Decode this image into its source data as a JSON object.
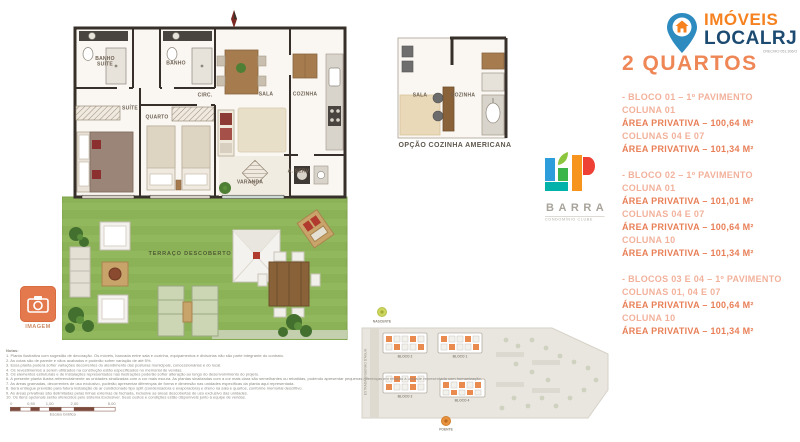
{
  "brand": {
    "top": "IMÓVEIS",
    "bottom": "LOCALRJ",
    "tagline": "CRECI/RJ 051.306/O"
  },
  "details": {
    "title": "2 QUARTOS",
    "sections": [
      {
        "lines": [
          {
            "t": "- BLOCO 01 – 1º PAVIMENTO"
          },
          {
            "t": "COLUNA 01"
          },
          {
            "t": "ÁREA PRIVATIVA – 100,64 M²"
          },
          {
            "t": "COLUNAS 04 E 07"
          },
          {
            "t": "ÁREA PRIVATIVA – 101,34 M²"
          }
        ]
      },
      {
        "lines": [
          {
            "t": "- BLOCO 02 – 1º PAVIMENTO"
          },
          {
            "t": "COLUNA 01"
          },
          {
            "t": "ÁREA PRIVATIVA – 101,01 M²"
          },
          {
            "t": "COLUNAS 04 E 07"
          },
          {
            "t": "ÁREA PRIVATIVA – 100,64 M²"
          },
          {
            "t": "COLUNA 10"
          },
          {
            "t": "ÁREA PRIVATIVA – 101,34 M²"
          }
        ]
      },
      {
        "lines": [
          {
            "t": "- BLOCOS 03 E 04 – 1º PAVIMENTO"
          },
          {
            "t": "COLUNAS 01, 04 E 07"
          },
          {
            "t": "ÁREA PRIVATIVA – 100,64 M²"
          },
          {
            "t": "COLUNA 10"
          },
          {
            "t": "ÁREA PRIVATIVA – 101,34 M²"
          }
        ]
      }
    ]
  },
  "up_logo": {
    "mark": "UP",
    "name": "BARRA",
    "subtitle": "CONDOMÍNIO CLUBE"
  },
  "plan": {
    "rooms": {
      "banho_suite": "BANHO\nSUÍTE",
      "banho": "BANHO",
      "circ": "CIRC.",
      "suite": "SUÍTE",
      "quarto": "QUARTO",
      "sala": "SALA",
      "cozinha": "COZINHA",
      "aserv": "A. SERV.",
      "varanda": "VARANDA",
      "terraco": "TERRAÇO DESCOBERTO"
    }
  },
  "option_plan": {
    "caption": "OPÇÃO COZINHA AMERICANA",
    "sala": "SALA",
    "cozinha": "COZINHA"
  },
  "image_button": {
    "label": "IMAGEM"
  },
  "site_plan": {
    "street": "ESTRADA ENGENHO D'ÁGUA",
    "blocks": [
      "BLOCO 2",
      "BLOCO 1",
      "BLOCO 3",
      "BLOCO 4"
    ],
    "marker_top": "NASCENTE",
    "marker_bottom": "POENTE"
  },
  "notes": {
    "heading": "Notas:",
    "lines": [
      "1. Planta ilustrativa com sugestão de decoração. Os móveis, bancada entre sala e cozinha, equipamentos e divisórias não são parte integrante do contrato.",
      "2. As cotas são de parede e vãos acabados e poderão sofrer variação de até 5%.",
      "3. Essa planta poderá sofrer variações decorrentes do atendimento das posturas municipais, concessionárias e do local.",
      "4. Os revestimentos a serem utilizados na construção estão especificados no memorial de vendas.",
      "5. Os elementos estruturais e de instalações representados nas ilustrações poderão sofrer alteração ao longo do desenvolvimento do projeto.",
      "6. A presente planta ilustra referencialmente as unidades sinalizadas com a cor mais escura. As plantas sinalizadas com a cor mais clara são semelhantes ou rebatidas, podendo apresentar pequenas diferenças em relação à unidade representada com humanização.",
      "7. As áreas gramadas, decorrentes de uso exclusivo, poderão apresentar diferenças de forma e dimensão nas unidades específicas da planta aqui representada.",
      "8. Será entregue previsão para futura instalação de ar condicionado tipo split (condensadora e evaporadora) e dreno na sala e quartos, conforme memorial descritivo.",
      "9. As áreas privativas são delimitadas pelas linhas externas de fachada, inclusive as áreas descobertas de uso exclusivo das unidades.",
      "10. Os itens opcionais serão oferecidos pelo sistema Exclusiver. Seus custos e condições estão disponíveis junto à equipe de vendas."
    ]
  },
  "scale_bar": {
    "label": "Escala Gráfica",
    "ticks": [
      "0",
      "0,50",
      "1,00",
      "2,00",
      "5,00"
    ]
  },
  "colors": {
    "accent_orange": "#f5821f",
    "navy": "#1c4a70",
    "salmon_title": "#ee8656",
    "salmon_bold": "#e87f57",
    "salmon_light": "#f2b19b",
    "grass": "#8cb258",
    "wall": "#37302a",
    "button_orange": "#e4794d"
  }
}
